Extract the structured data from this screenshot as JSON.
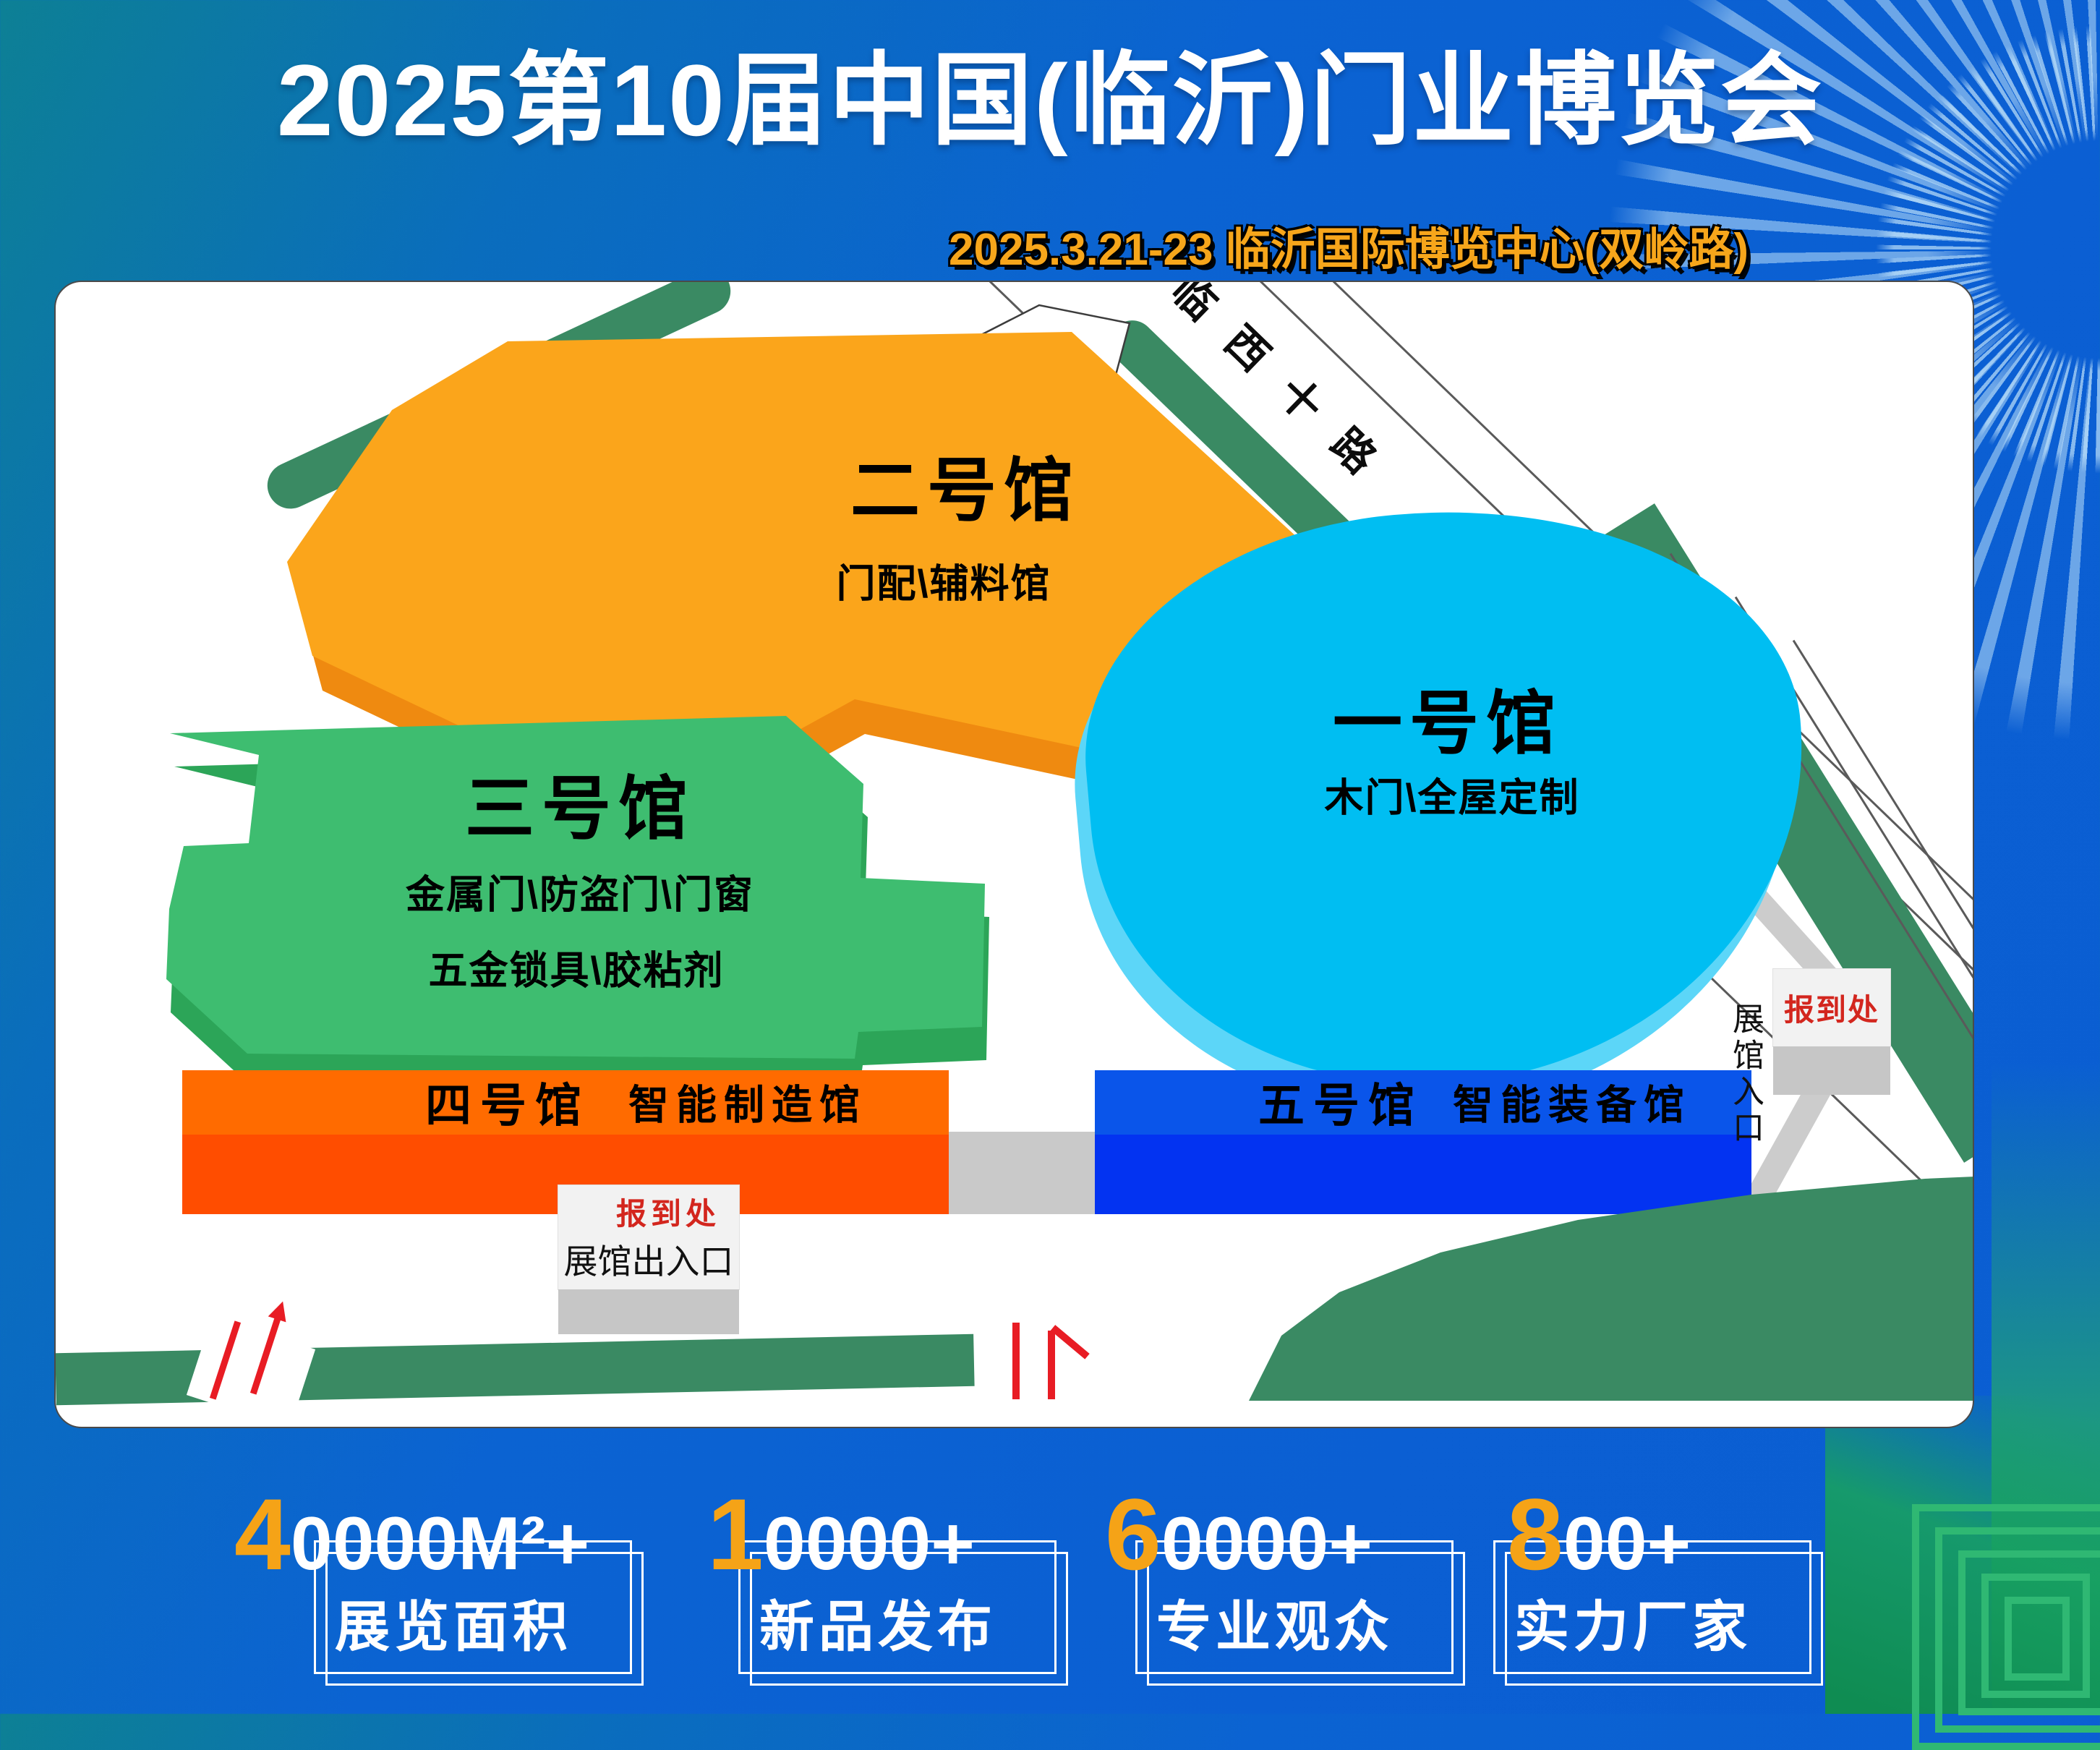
{
  "header": {
    "title": "2025第10届中国(临沂)门业博览会",
    "subtitle": "2025.3.21-23 临沂国际博览中心(双岭路)"
  },
  "map": {
    "hotel_label": "酒店",
    "road_label": "临西十路",
    "halls": [
      {
        "id": "hall-1",
        "name": "一号馆",
        "desc": "木门\\全屋定制",
        "color": "#00BEF2"
      },
      {
        "id": "hall-2",
        "name": "二号馆",
        "desc": "门配\\辅料馆",
        "color": "#FBA51B"
      },
      {
        "id": "hall-3",
        "name": "三号馆",
        "desc": "金属门\\防盗门\\门窗",
        "desc2": "五金锁具\\胶粘剂",
        "color": "#3EBD70"
      },
      {
        "id": "hall-4",
        "name": "四号馆",
        "desc": "智能制造馆",
        "color": "#FF6B00"
      },
      {
        "id": "hall-5",
        "name": "五号馆",
        "desc": "智能装备馆",
        "color": "#0A55EA"
      }
    ],
    "registration_south": {
      "title": "报到处",
      "subtitle": "展馆出入口"
    },
    "registration_east": {
      "title": "报到处",
      "entrance_label": "展馆入口"
    }
  },
  "stats": [
    {
      "prefix": "4",
      "rest": "0000M²+",
      "label": "展览面积"
    },
    {
      "prefix": "1",
      "rest": "0000+",
      "label": "新品发布"
    },
    {
      "prefix": "6",
      "rest": "0000+",
      "label": "专业观众"
    },
    {
      "prefix": "8",
      "rest": "00+",
      "label": "实力厂家"
    }
  ],
  "colors": {
    "background_blue": "#0B61D5",
    "background_teal": "#0D8095",
    "accent_orange": "#F7A61B",
    "hall1_cyan": "#00BEF2",
    "hall2_orange": "#FBA51B",
    "hall3_green": "#3EBD70",
    "hall4_red_orange": "#FF4D00",
    "hall5_blue": "#0333F1",
    "road_green": "#3A8A63",
    "registration_red": "#D3261E",
    "arrow_red": "#E81C24"
  }
}
